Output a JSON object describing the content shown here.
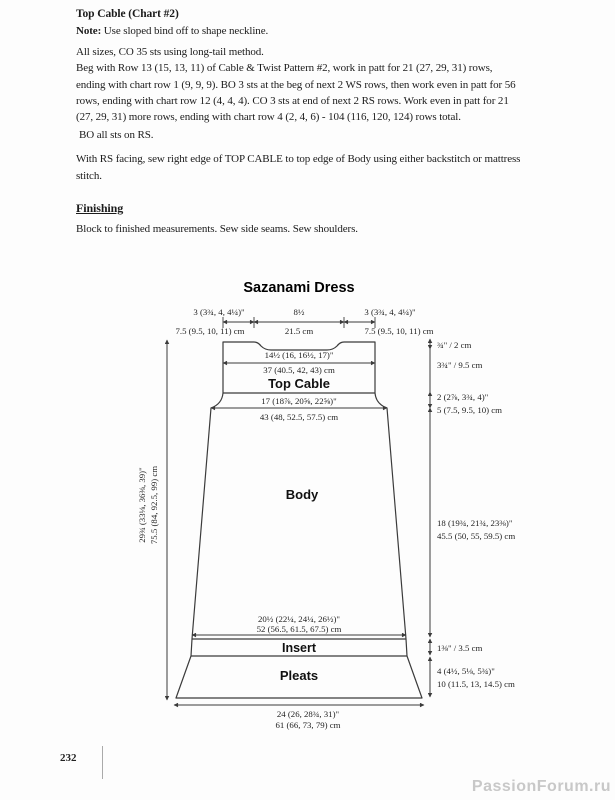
{
  "page": {
    "number": "232",
    "watermark": "PassionForum.ru"
  },
  "instructions": {
    "heading": "Top Cable (Chart #2)",
    "note_label": "Note:",
    "note_text": " Use sloped bind off to shape neckline.",
    "para1_lines": [
      "All sizes, CO 35 sts using long-tail method.",
      "Beg with Row 13 (15, 13, 11) of Cable & Twist Pattern #2, work in patt for 21 (27, 29, 31) rows,",
      "ending with chart row 1 (9, 9, 9).  BO 3 sts at the beg of next 2 WS rows, then work even in patt for 56",
      "rows, ending with chart row 12 (4, 4, 4). CO 3 sts at end of next 2 RS rows. Work even in patt for 21",
      "(27, 29, 31) more rows, ending with chart row 4 (2, 4, 6) - 104 (116, 120, 124) rows total."
    ],
    "bo_line": "BO all sts on RS.",
    "sew_lines": [
      "With RS facing, sew right edge of TOP CABLE to top edge of Body using either backstitch or mattress",
      "stitch."
    ],
    "finishing_heading": "Finishing",
    "finishing_text": "Block to finished measurements.  Sew side seams. Sew shoulders."
  },
  "schematic": {
    "title": "Sazanami Dress",
    "labels": {
      "top_cable": "Top Cable",
      "body": "Body",
      "insert": "Insert",
      "pleats": "Pleats"
    },
    "dims": {
      "shoulder_left_in": "3 (3¾, 4, 4¼)\"",
      "shoulder_left_cm": "7.5 (9.5, 10, 11) cm",
      "neck_in": "8½",
      "neck_cm": "21.5 cm",
      "shoulder_right_in": "3 (3¾, 4, 4¼)\"",
      "shoulder_right_cm": "7.5 (9.5, 10, 11) cm",
      "cable_width_in": "14½ (16, 16½, 17)\"",
      "cable_width_cm": "37 (40.5, 42, 43) cm",
      "neck_drop": "¾\" / 2 cm",
      "cable_height": "3¾\" / 9.5 cm",
      "flare_in": "2 (2⅞, 3¾, 4)\"",
      "flare_cm": "5 (7.5, 9.5, 10) cm",
      "body_top_in": "17 (18⅞, 20⅝, 22⅝)\"",
      "body_top_cm": "43 (48, 52.5, 57.5) cm",
      "body_len_in": "18 (19¾, 21¾, 23⅜)\"",
      "body_len_cm": "45.5 (50, 55, 59.5) cm",
      "total_len_in": "29¾ (33⅛, 36⅜, 39)\"",
      "total_len_cm": "75.5 (84, 92.5, 99) cm",
      "insert_w_in": "20½ (22¼, 24¼, 26½)\"",
      "insert_w_cm": "52 (56.5, 61.5, 67.5) cm",
      "insert_h": "1⅜\" / 3.5 cm",
      "pleats_h_in": "4 (4½, 5⅛, 5¾)\"",
      "pleats_h_cm": "10 (11.5, 13, 14.5) cm",
      "hem_in": "24 (26, 28¾, 31)\"",
      "hem_cm": "61 (66, 73, 79) cm"
    }
  }
}
